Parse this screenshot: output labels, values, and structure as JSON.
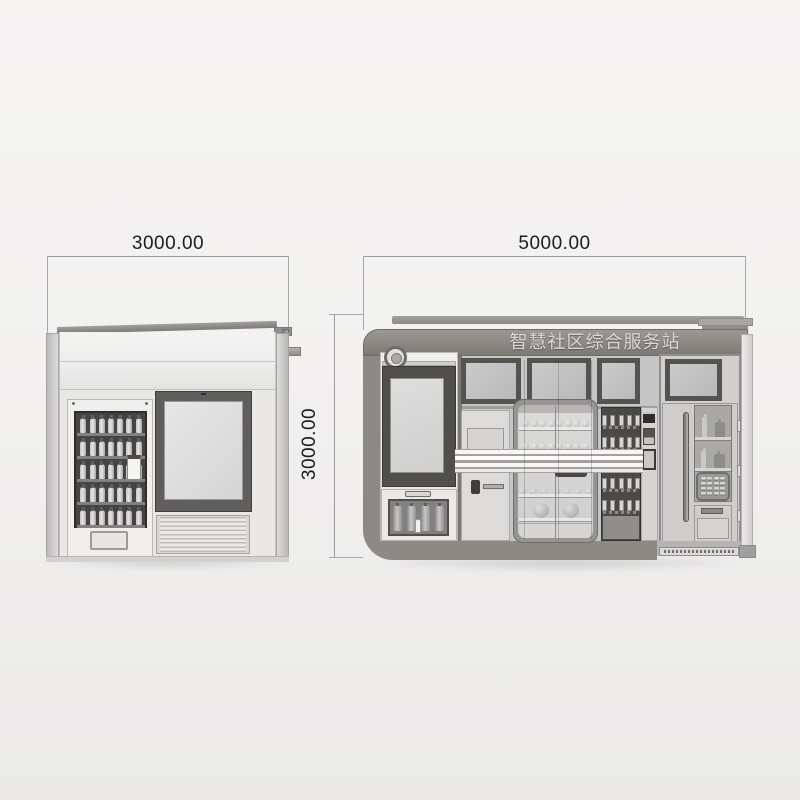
{
  "annotations": {
    "left_view_width": "3000.00",
    "front_view_width": "5000.00",
    "front_view_height": "3000.00"
  },
  "signage": {
    "fascia_text": "智慧社区综合服务站"
  },
  "generators": {
    "left_vending": {
      "rows": 5,
      "bottles_per_row": 7
    },
    "kiosk_dispenser": {
      "cylinders": 4
    },
    "display_case": {
      "row1_items": 8,
      "row2_items": 8,
      "row3_items": 7,
      "row4_items": 2
    },
    "right_vending": {
      "rows": 4,
      "boxes_per_row": 5
    },
    "parcel_locker": {
      "cells": 16
    }
  }
}
